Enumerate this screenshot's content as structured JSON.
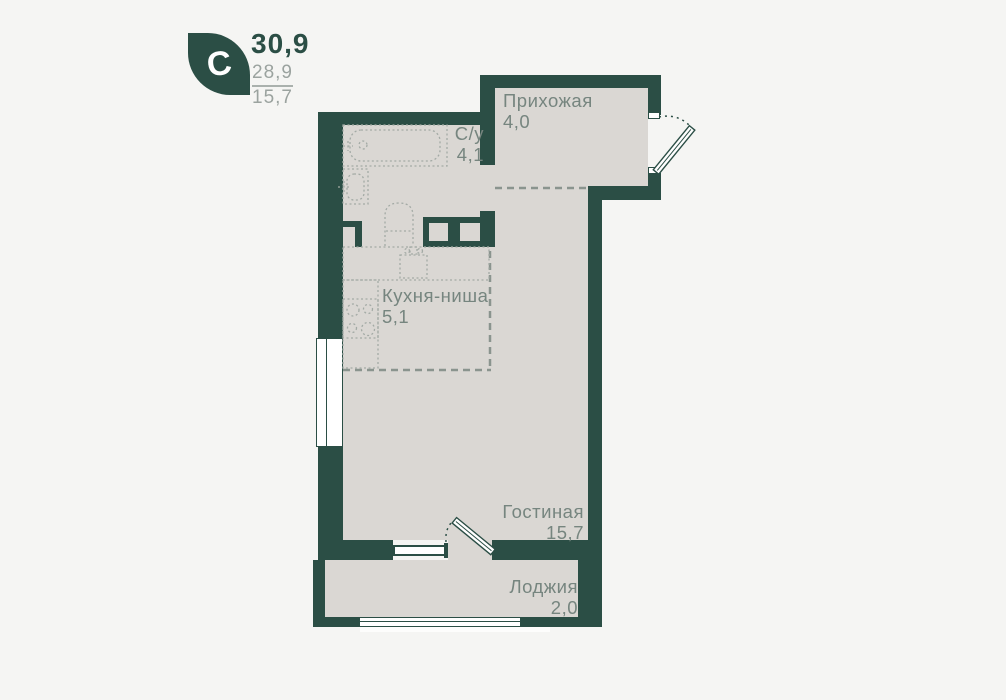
{
  "header": {
    "logo_letter": "C",
    "area_total": "30,9",
    "area_living": "28,9",
    "area_secondary": "15,7"
  },
  "rooms": [
    {
      "name": "Прихожая",
      "area": "4,0"
    },
    {
      "name": "С/у",
      "area": "4,1"
    },
    {
      "name": "Кухня-ниша",
      "area": "5,1"
    },
    {
      "name": "Гостиная",
      "area": "15,7"
    },
    {
      "name": "Лоджия",
      "area": "2,0"
    }
  ],
  "fixtures": [
    "bathtub",
    "washbasin",
    "toilet",
    "kitchen-sink",
    "stove",
    "entry-door",
    "balcony-door",
    "windows"
  ],
  "colors": {
    "wall": "#2b4e45",
    "floor": "#dad7d3",
    "background": "#f5f5f3",
    "label_text": "#76857f"
  }
}
